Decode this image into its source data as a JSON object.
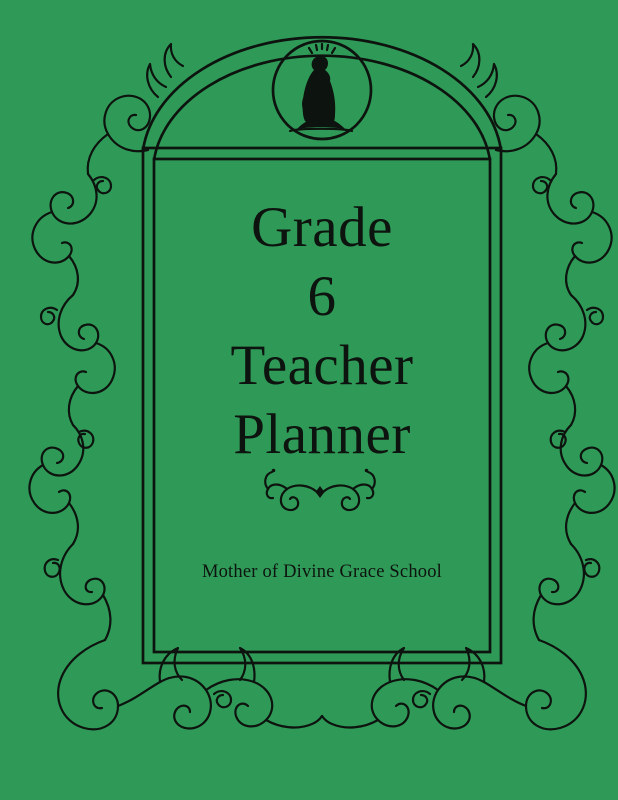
{
  "cover": {
    "title_lines": [
      "Grade",
      "6",
      "Teacher",
      "Planner"
    ],
    "school_name": "Mother of Divine Grace School",
    "colors": {
      "background": "#2F9A57",
      "ink": "#0D130E"
    },
    "icons": {
      "medallion": "madonna-medallion-icon",
      "divider": "fleuron-flourish-icon",
      "border": "acanthus-vine-border"
    }
  }
}
